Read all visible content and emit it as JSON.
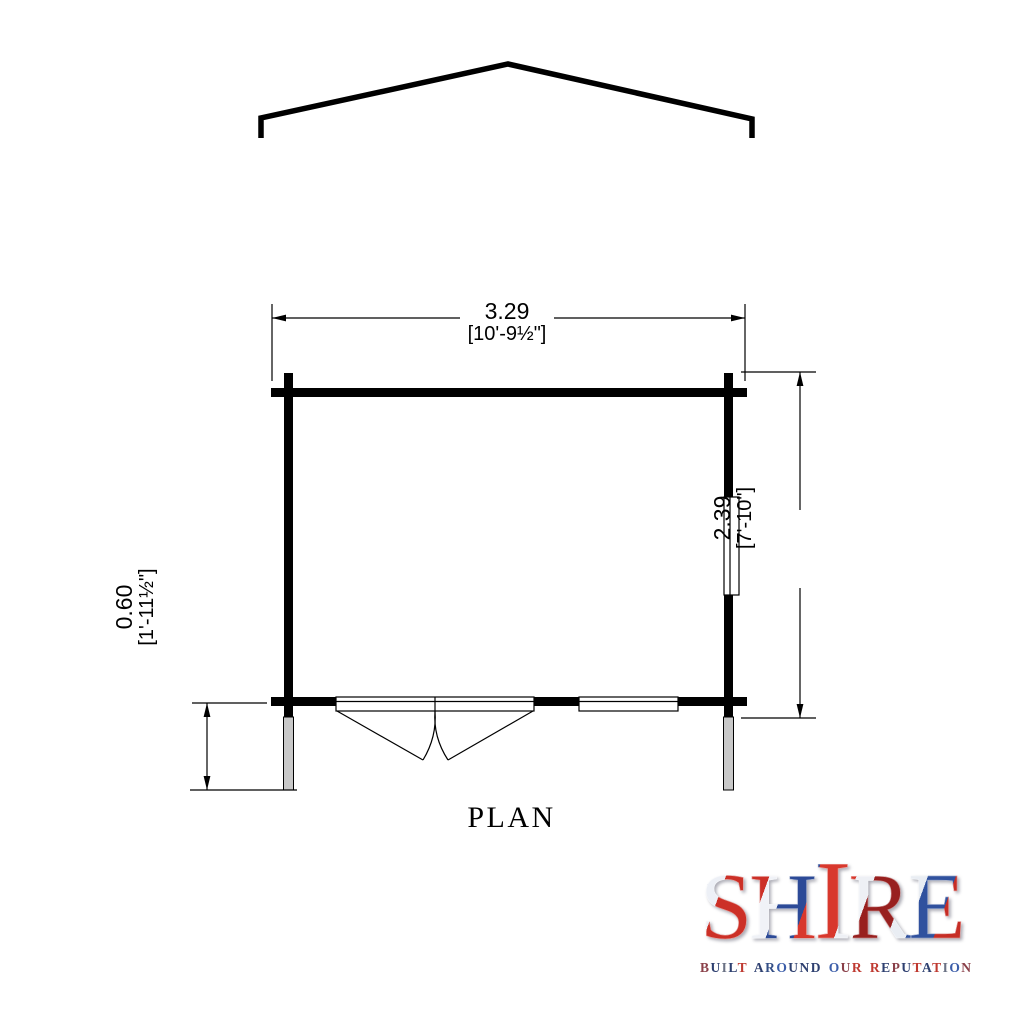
{
  "page": {
    "background": "#ffffff"
  },
  "drawing": {
    "plan_label": "PLAN",
    "dimensions": {
      "width_metric": "3.29",
      "width_imperial": "[10'-9½\"]",
      "depth_metric": "2.39",
      "depth_imperial": "[7'-10\"]",
      "overhang_metric": "0.60",
      "overhang_imperial": "[1'-11½\"]"
    },
    "colors": {
      "line": "#000000",
      "post_fill": "#c8c8c8",
      "background": "#ffffff"
    }
  },
  "logo": {
    "word": "SHIRE",
    "letters": [
      "S",
      "H",
      "I",
      "R",
      "E"
    ],
    "tagline": "BUILT AROUND OUR REPUTATION",
    "tagline_letter_colors": [
      "#8a4049",
      "#2e4070",
      "#6a7184",
      "#2e4070",
      "#bf3a31",
      "",
      "#2e4070",
      "#344f86",
      "#3b5da9",
      "#2e4070",
      "#2e4070",
      "#2e4070",
      "",
      "#3b5da9",
      "#8a4049",
      "#bf3a31",
      "",
      "#bf3a31",
      "#2e4070",
      "#8a4049",
      "#2e4070",
      "#bf3a31",
      "#2e4070",
      "#bf3a31",
      "#6a7184",
      "#3b5da9",
      "#8a4049"
    ],
    "flag_colors": {
      "blue": "#27428c",
      "red": "#cc3027",
      "dark_red": "#98201f",
      "white": "#eef0f5"
    }
  }
}
